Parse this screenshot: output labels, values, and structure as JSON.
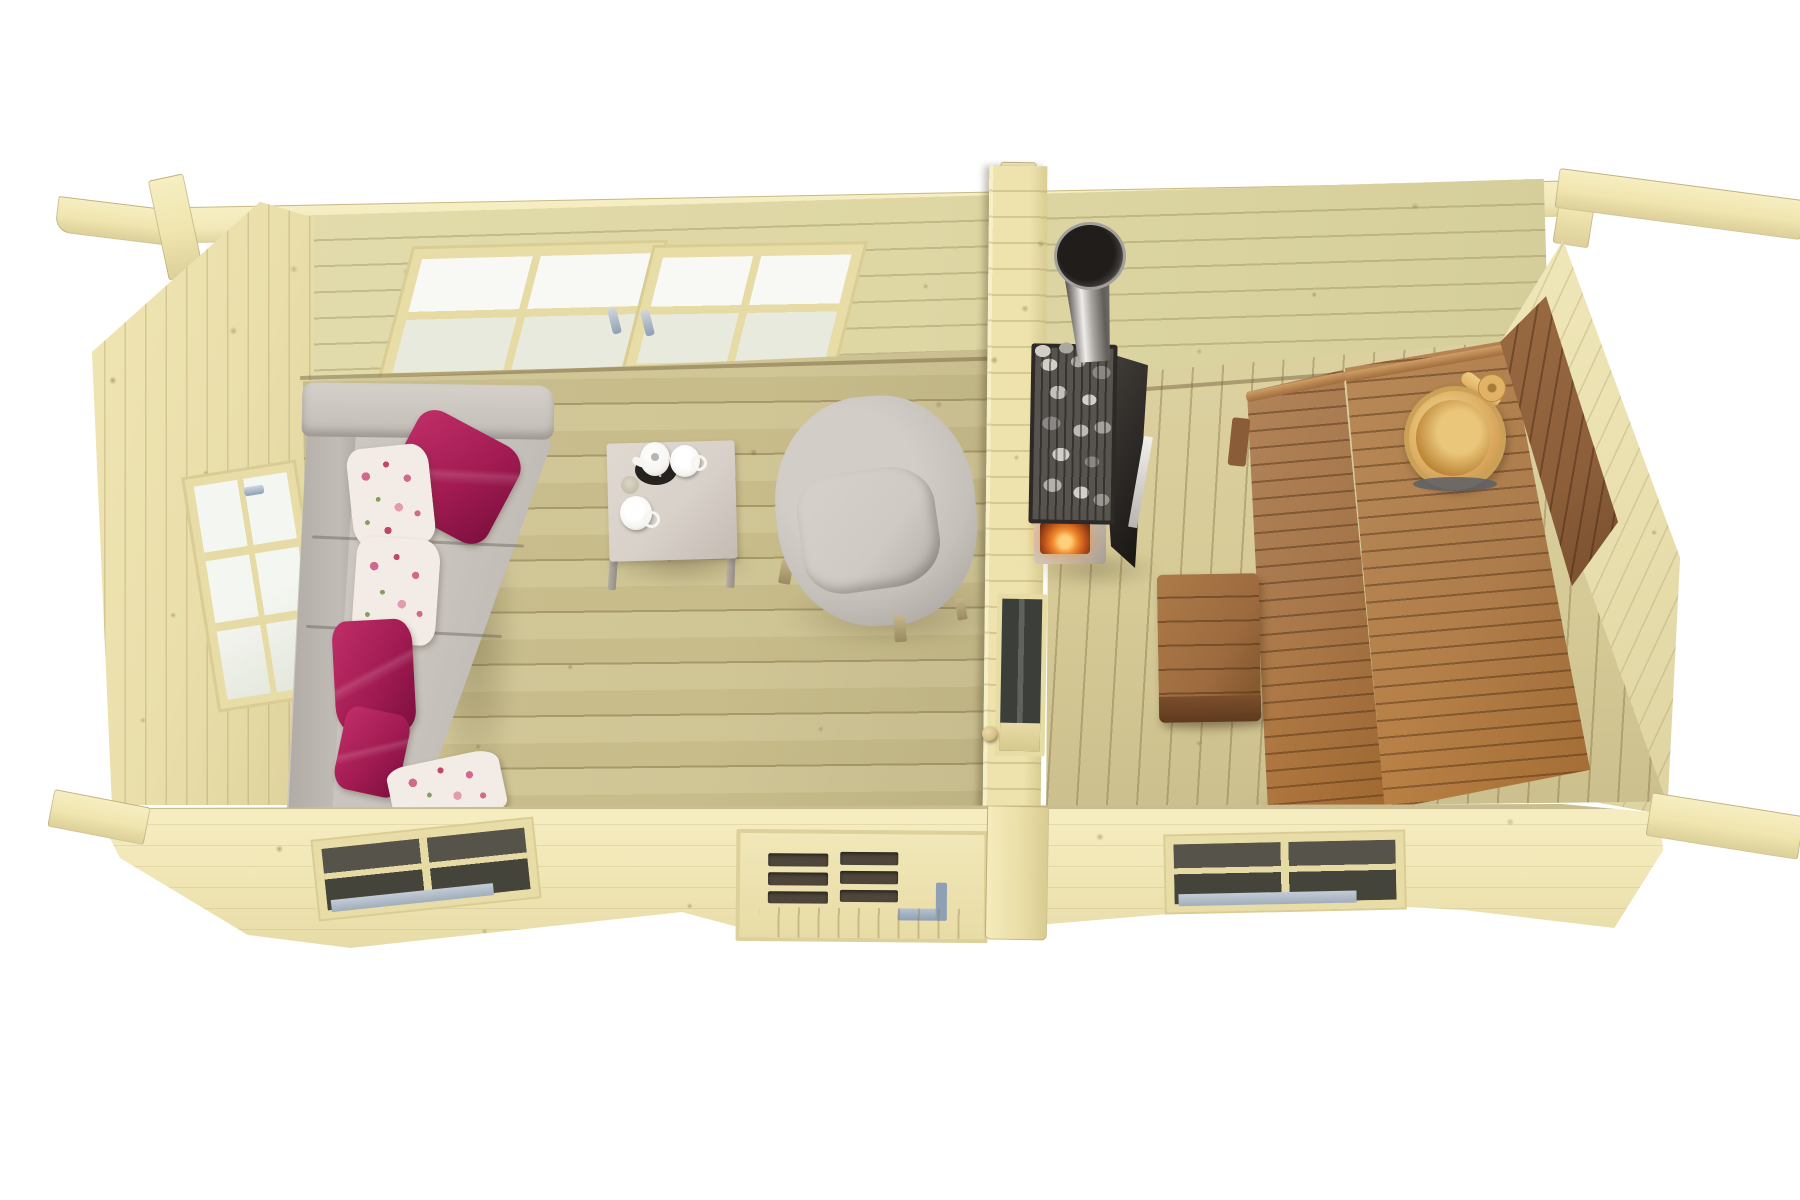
{
  "scene": {
    "description": "Top-down 3D cutaway render of a two-room log cabin: lounge with sofa, coffee table and armchair on the left; sauna with wood-burning stove, tiered benches, stool and bucket on the right.",
    "rooms": [
      {
        "name": "lounge",
        "furniture": [
          "sofa",
          "coffee-table",
          "armchair"
        ],
        "pillows": {
          "magenta": 3,
          "floral": 3
        },
        "tableware": [
          "teapot",
          "tray",
          "mug",
          "cup",
          "glass"
        ],
        "windows": {
          "back_wall": 2,
          "gable_wall": 1,
          "front_wall": 1
        }
      },
      {
        "name": "sauna",
        "furniture": [
          "wood-stove",
          "chimney",
          "lower-bench",
          "upper-bench",
          "backrest",
          "stool",
          "bucket-with-ladle"
        ],
        "windows": {
          "front_wall": 1
        }
      }
    ],
    "doors": [
      "front-door-glazed",
      "sauna-glass-door"
    ],
    "structure": [
      "log-walls",
      "partition-wall",
      "ridge-beam-stubs",
      "purlin-overhangs"
    ]
  },
  "colors": {
    "bg": "#ffffff",
    "beam": "#f0e5ae",
    "plate": "#f2e8ba",
    "wall_back": "#ded7a4",
    "wall_ext": "#eadfab",
    "wall_right": "#e9dfae",
    "partition": "#eee3ad",
    "floor_living": "#cdc28f",
    "floor_sauna": "#d6ca97",
    "front_band": "#f1e7b6",
    "frame": "#e8dda6",
    "glass_bright": "#f8f9f5",
    "glass_dim": "#e8eadd",
    "glass_dark": "#45443a",
    "sill": "#a0adbb",
    "handle": "#8fa0b4",
    "door_glass": "#4e463a",
    "knob": "#d8c289",
    "sofa": "#c9c3bd",
    "sofa_dark": "#b0aaa4",
    "sofa_light": "#d5d0ca",
    "magenta": "#a21b52",
    "magenta_dark": "#7c0f3d",
    "floral_base": "#f3ece6",
    "floral_pink": "#d06a8c",
    "floral_green": "#85a05e",
    "table": "#d8d1c9",
    "china": "#f6f5f2",
    "tray": "#26221e",
    "chair": "#c5c0ba",
    "chair_seat": "#cfcac3",
    "stove_dark": "#2c2926",
    "stove_body": "#c9c3bb",
    "stone_light": "#d2cec8",
    "stone_dark": "#8b8784",
    "steel_light": "#e8e6e2",
    "steel_dark": "#504d49",
    "fire": "#f08c2e",
    "bench_upper": "#ad7c4c",
    "bench_lower": "#a5754a",
    "bench_dark": "#6e4424",
    "bench_glow": "#e08a2e",
    "backrest": "#8d5f3a",
    "stool": "#9c6a3e",
    "bucket": "#d9a85e",
    "bucket_inner": "#c08a3c",
    "bucket_band": "#5d5f68"
  }
}
